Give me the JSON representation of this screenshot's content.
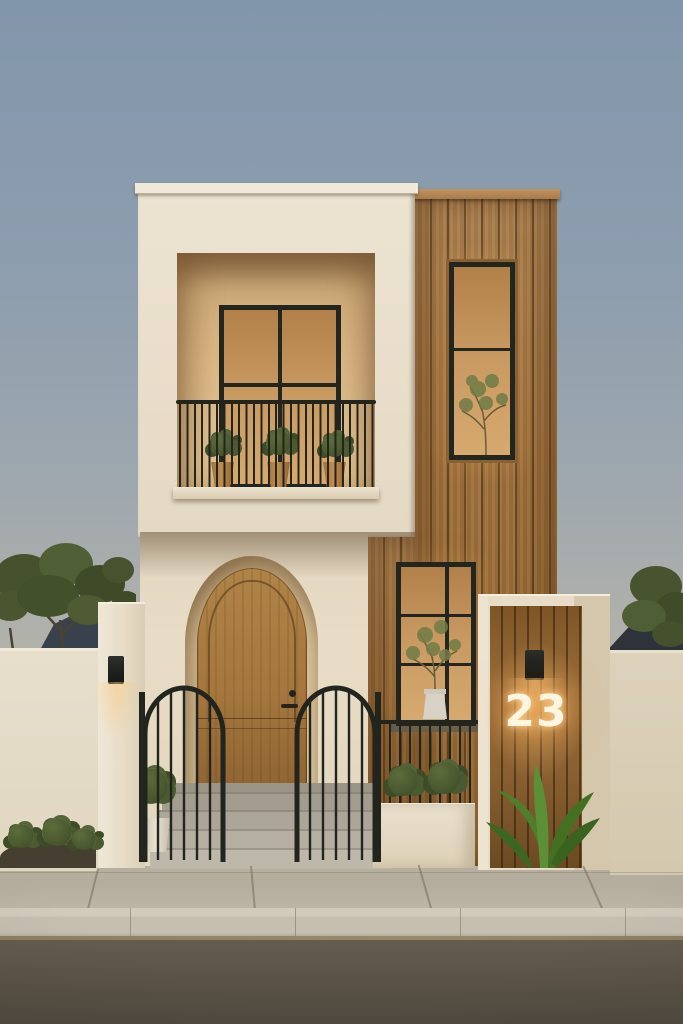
{
  "scene": {
    "type": "architectural-exterior-render",
    "time_of_day": "dusk",
    "house": {
      "number_label": "23",
      "storeys": 2,
      "balcony_pot_count": 3,
      "gate_count": 2,
      "wall_sconce_count": 2
    },
    "palette": {
      "sky_top": "#8296ab",
      "sky_horizon": "#cbc2b0",
      "stucco": "#e6dcc8",
      "wood_cladding": "#a0713d",
      "window_frame": "#23261f",
      "window_glow": "#d4a76e",
      "terracotta": "#b9854d",
      "foliage": "#4c5a31",
      "steps_concrete": "#b2aca0",
      "sidewalk": "#b6ae9e",
      "curb": "#c6bfb0",
      "road": "#5a5347",
      "number_glow": "#fff6e1"
    }
  }
}
